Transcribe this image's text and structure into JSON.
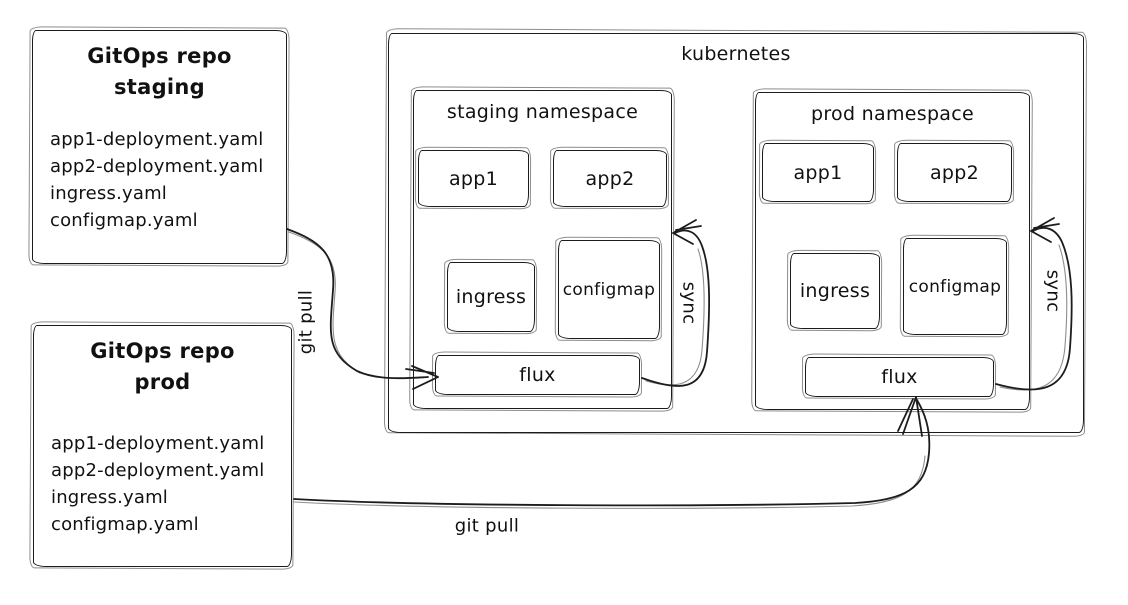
{
  "colors": {
    "stroke": "#1c1c1c",
    "background": "#ffffff",
    "text": "#111111"
  },
  "repos": [
    {
      "title_line1": "GitOps repo",
      "title_line2": "staging",
      "files": [
        "app1-deployment.yaml",
        "app2-deployment.yaml",
        "ingress.yaml",
        "configmap.yaml"
      ]
    },
    {
      "title_line1": "GitOps repo",
      "title_line2": "prod",
      "files": [
        "app1-deployment.yaml",
        "app2-deployment.yaml",
        "ingress.yaml",
        "configmap.yaml"
      ]
    }
  ],
  "kubernetes": {
    "label": "kubernetes",
    "namespaces": [
      {
        "label": "staging namespace",
        "apps": [
          "app1",
          "app2"
        ],
        "resources": [
          "ingress",
          "configmap"
        ],
        "flux": "flux",
        "sync_label": "sync"
      },
      {
        "label": "prod namespace",
        "apps": [
          "app1",
          "app2"
        ],
        "resources": [
          "ingress",
          "configmap"
        ],
        "flux": "flux",
        "sync_label": "sync"
      }
    ]
  },
  "arrows": {
    "staging_git_pull_label": "git pull",
    "prod_git_pull_label": "git pull"
  }
}
